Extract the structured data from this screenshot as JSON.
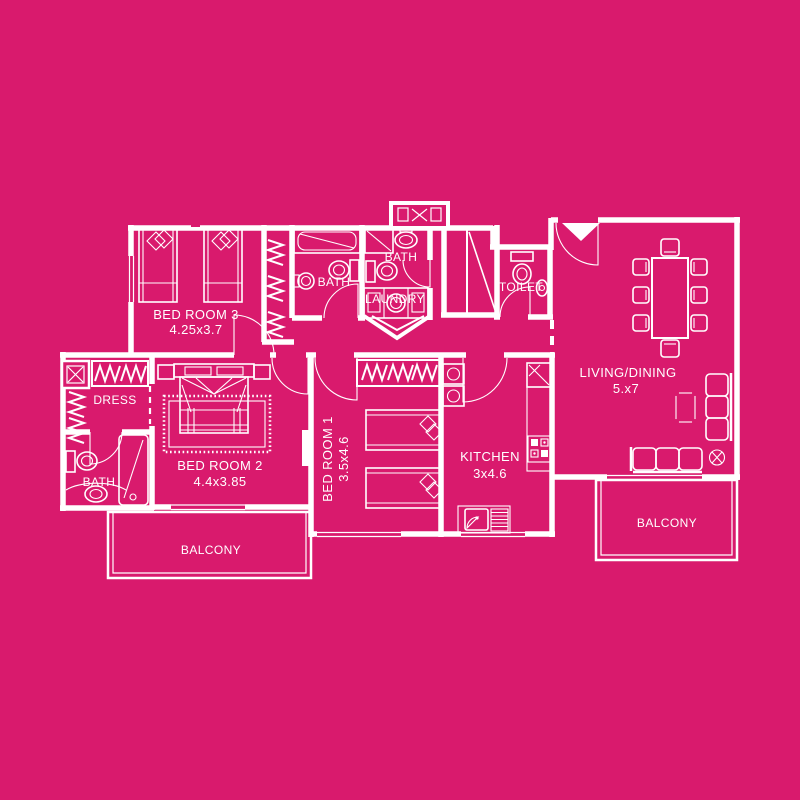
{
  "colors": {
    "background": "#D91A6D",
    "line": "#FFFFFF"
  },
  "plan": {
    "rooms": {
      "bedroom3": {
        "name": "BED ROOM 3",
        "dims": "4.25x3.7"
      },
      "bath1": {
        "name": "BATH"
      },
      "bath2": {
        "name": "BATH"
      },
      "laundry": {
        "name": "LAUNDRY"
      },
      "toilet": {
        "name": "TOILET"
      },
      "living": {
        "name": "LIVING/DINING",
        "dims": "5.x7"
      },
      "dress": {
        "name": "DRESS"
      },
      "bath3": {
        "name": "BATH"
      },
      "bedroom2": {
        "name": "BED ROOM 2",
        "dims": "4.4x3.85"
      },
      "bedroom1": {
        "name": "BED ROOM 1",
        "dims": "3.5x4.6"
      },
      "kitchen": {
        "name": "KITCHEN",
        "dims": "3x4.6"
      },
      "balcony_left": {
        "name": "BALCONY"
      },
      "balcony_right": {
        "name": "BALCONY"
      }
    }
  }
}
